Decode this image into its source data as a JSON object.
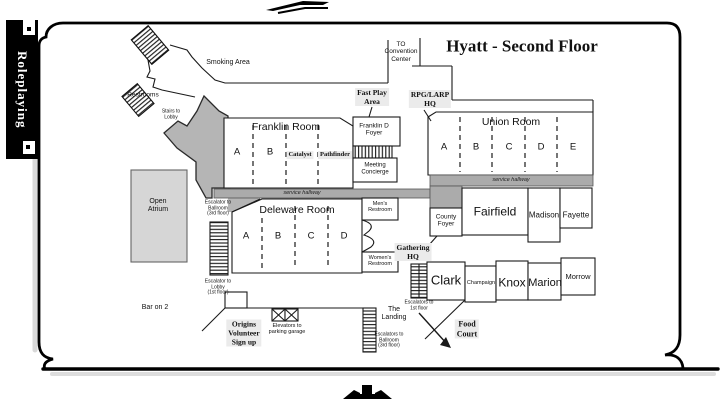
{
  "tab": {
    "label": "Roleplaying"
  },
  "title": "Hyatt - Second Floor",
  "colors": {
    "line": "#1a1a1a",
    "map_gray": "#b5b5b5",
    "hallway_gray": "#ababab",
    "atrium_gray": "#d6d6d6",
    "highlight_bg": "#ebebeb",
    "tab_bg": "#000000"
  },
  "labels": {
    "smoking_area": "Smoking Area",
    "restrooms": "Restrooms",
    "stairs_to_lobby": "Stairs to\nLobby",
    "to_convention_center": "TO\nConvention\nCenter",
    "fast_play_area": "Fast Play\nArea",
    "rpg_larp_hq": "RPG/LARP\nHQ",
    "franklin_d_foyer": "Franklin D\nFoyer",
    "meeting_concierge": "Meeting\nConcierge",
    "service_hallway": "service hallway",
    "open_atrium": "Open\nAtrium",
    "escalator_to_ballroom": "Escalator to\nBallroom\n(3rd floor)",
    "escalator_to_lobby": "Escalator to\nLobby\n(1st floor)",
    "mens_restroom": "Men's\nRestroom",
    "womens_restroom": "Women's\nRestroom",
    "county_foyer": "County\nFoyer",
    "gathering_hq": "Gathering\nHQ",
    "bar_on_2": "Bar on 2",
    "origins_volunteer_signup": "Origins\nVolunteer\nSign up",
    "elevators_to_parking": "Elevators to\nparking garage",
    "the_landing": "The\nLanding",
    "escalators_to_ballroom": "Escalators to\nBallroom\n(3rd floor)",
    "escalators_to_1st_floor": "Escalators to\n1st floor",
    "food_court": "Food\nCourt"
  },
  "rooms": {
    "franklin": {
      "name": "Franklin Room",
      "sections": [
        "A",
        "B"
      ],
      "events": [
        "Catalyst",
        "Pathfinder"
      ]
    },
    "union": {
      "name": "Union Room",
      "sections": [
        "A",
        "B",
        "C",
        "D",
        "E"
      ]
    },
    "deleware": {
      "name": "Deleware Room",
      "sections": [
        "A",
        "B",
        "C",
        "D"
      ]
    },
    "fairfield": "Fairfield",
    "madison": "Madison",
    "fayette": "Fayette",
    "clark": "Clark",
    "champaign": "Champaign",
    "knox": "Knox",
    "marion": "Marion",
    "morrow": "Morrow"
  }
}
